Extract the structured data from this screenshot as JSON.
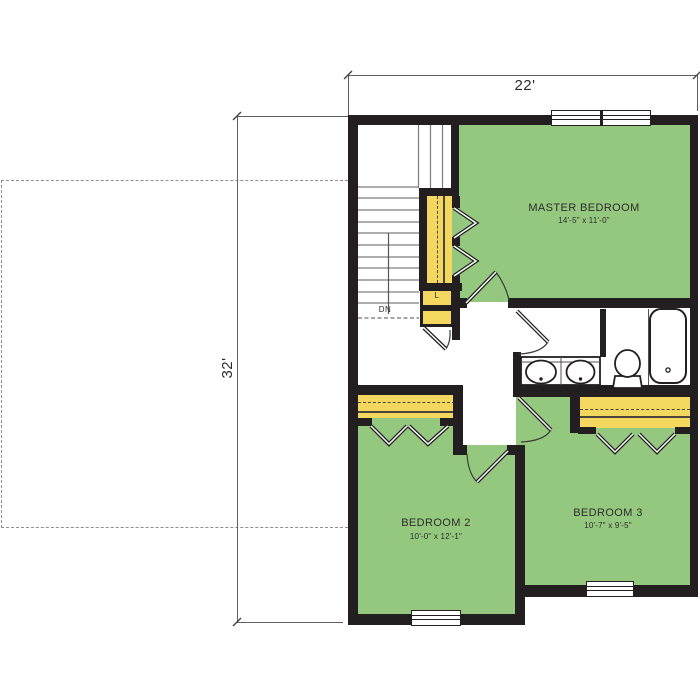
{
  "dimensions": {
    "top_width": "22'",
    "left_height": "32'"
  },
  "rooms": [
    {
      "name": "MASTER BEDROOM",
      "size": "14'-5\" x 11'-0\""
    },
    {
      "name": "BEDROOM 2",
      "size": "10'-0\" x 12'-1\""
    },
    {
      "name": "BEDROOM 3",
      "size": "10'-7\" x 9'-5\""
    }
  ],
  "stairs": {
    "down_label": "DN"
  },
  "closets": {
    "linen_label": "L"
  },
  "colors": {
    "room_green": "#94c87f",
    "closet_yellow": "#f4d75e",
    "wall_black": "#231f20",
    "line_gray": "#7d7d7d"
  },
  "fixtures": [
    "stairs-down",
    "master-closet",
    "linen-closet",
    "bifold-doors",
    "double-sink-vanity",
    "toilet",
    "bathtub",
    "window"
  ]
}
